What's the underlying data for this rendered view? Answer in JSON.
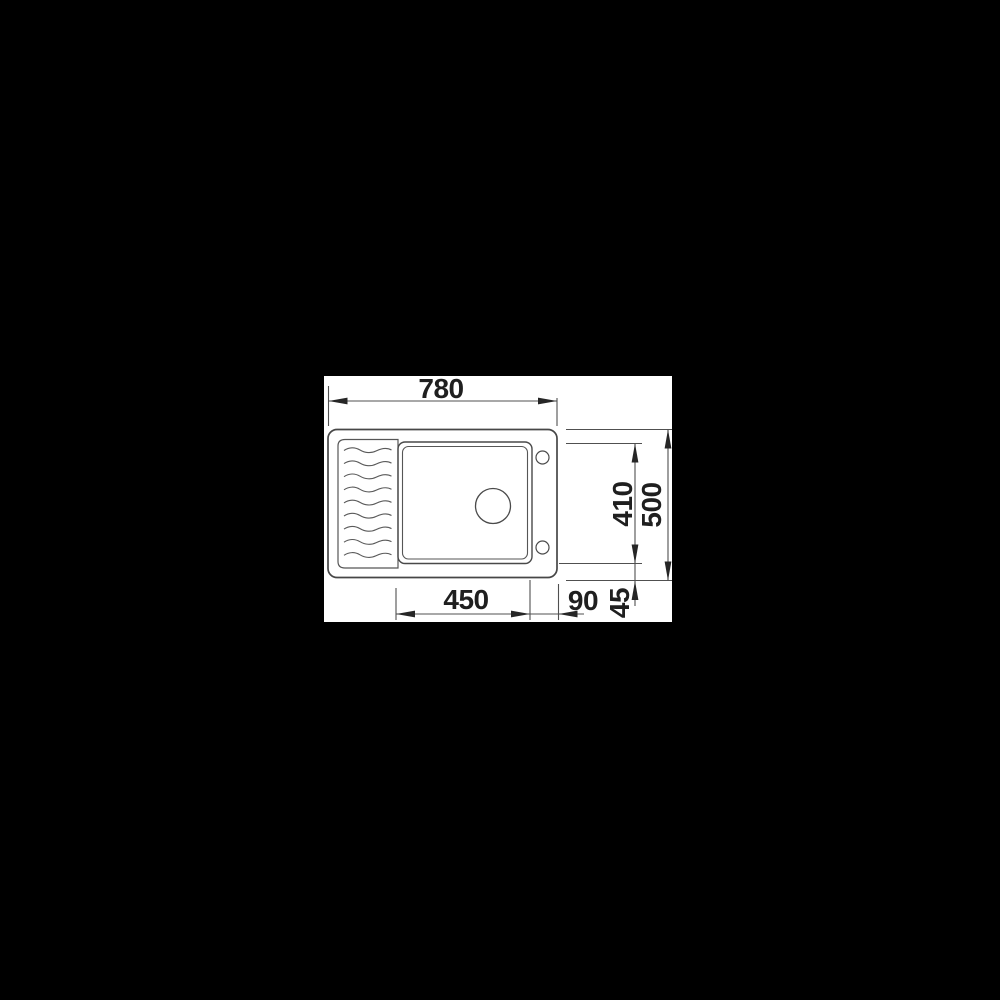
{
  "drawing": {
    "dimensions": {
      "overall_width_mm": "780",
      "overall_depth_mm": "500",
      "bowl_depth_mm": "410",
      "bowl_width_mm": "450",
      "tap_ledge_width_mm": "90",
      "rim_offset_mm": "45"
    },
    "colors": {
      "background": "#000000",
      "paper": "#ffffff",
      "line": "#4c4c4c",
      "text": "#1f1f1f"
    }
  }
}
